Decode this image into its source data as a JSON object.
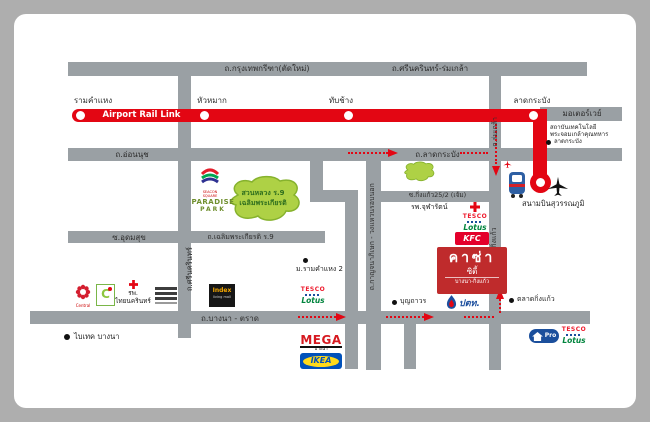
{
  "project": {
    "name": "คาซ่า",
    "type": "ซิตี้",
    "area": "บางนา-กิ่งแก้ว"
  },
  "rail": {
    "label": "Airport Rail Link",
    "color": "#e30613",
    "stations": [
      {
        "name": "รามคำแหง"
      },
      {
        "name": "หัวหมาก"
      },
      {
        "name": "ทับช้าง"
      },
      {
        "name": "ลาดกระบัง"
      }
    ],
    "terminus": "สนามบินสุวรรณภูมิ"
  },
  "roads": {
    "krungthep_kreetha": "ถ.กรุงเทพกรีฑา(ตัดใหม่)",
    "srinakarin_romklao": "ถ.ศรีนครินทร์-ร่มเกล้า",
    "motorway": "มอเตอร์เวย์",
    "onnut": "ถ.อ่อนนุช",
    "latkrabang": "ถ.ลาดกระบัง",
    "soi_kingkaew252": "ซ.กิ่งแก้ว25/2 (เจ้ม)",
    "romklao": "ถ.ร่มเกล้า",
    "kingkaew": "ถ.กิ่งแก้ว",
    "chalermprakiat": "ถ.เฉลิมพระเกียรติ ร.9",
    "udomsuk": "ซ.อุดมสุข",
    "srinakarin": "ถ.ศรีนครินทร์",
    "kanchanapisek": "ถ.กาญจนาภิเษก - วงแหวนรอบนอก",
    "bangna_trad": "ถ.บางนา - ตราด"
  },
  "places": {
    "kmitl_line1": "สถาบันเทคโนโลยี",
    "kmitl_line2": "พระจอมเกล้าคุณทหาร",
    "kmitl_line3": "ลาดกระบัง",
    "park_line1": "สวนหลวง ร.9",
    "park_line2": "เฉลิมพระเกียรติ",
    "ram2": "ม.รามคำแหง 2",
    "chularat": "รพ.จุฬารัตน์",
    "thainakarin_line1": "รพ.",
    "thainakarin_line2": "ไทยนครินทร์",
    "bitec": "ไบเทค บางนา",
    "boonthavorn": "บุญถาวร",
    "kingkaew_market": "ตลาดกิ่งแก้ว",
    "airport": "สนามบินสุวรรณภูมิ"
  },
  "logos": {
    "seacon": "SEACON SQUARE",
    "paradise1": "PARADISE",
    "paradise2": "PARK",
    "tesco": "TESCO",
    "lotus": "Lotus",
    "kfc": "KFC",
    "mega": "MEGA",
    "mega_sub": "บางนา",
    "ikea": "IKEA",
    "index": "Index",
    "index_sub": "living mall",
    "homepro": "Pro",
    "ptt": "ปตท.",
    "central": "Central",
    "bigc": "C"
  },
  "colors": {
    "road": "#9aa0a4",
    "rail": "#e30613",
    "project": "#bf2b2c",
    "park": "#aed145"
  }
}
